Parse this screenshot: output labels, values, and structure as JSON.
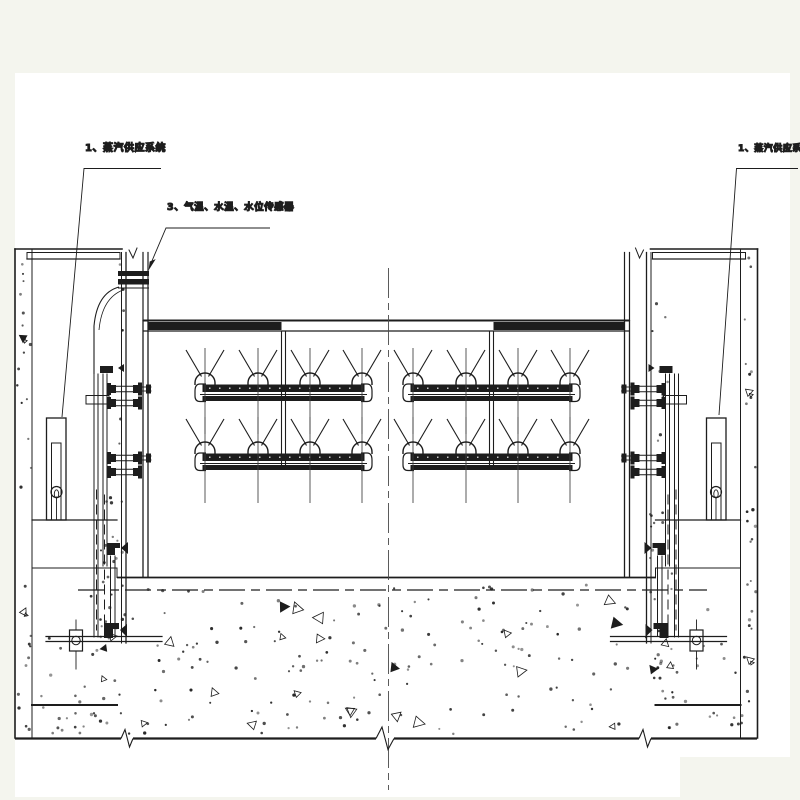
{
  "labels": {
    "steam_supply_left": "1、蒸汽供应系统",
    "sensors": "3、气温、水温、水位传感器",
    "steam_supply_right": "1、蒸汽供应系统"
  },
  "colors": {
    "page_bg": "#f4f5ee",
    "canvas_bg": "#ffffff",
    "line": "#1d1d1d",
    "centerline": "#4a4a4a"
  }
}
